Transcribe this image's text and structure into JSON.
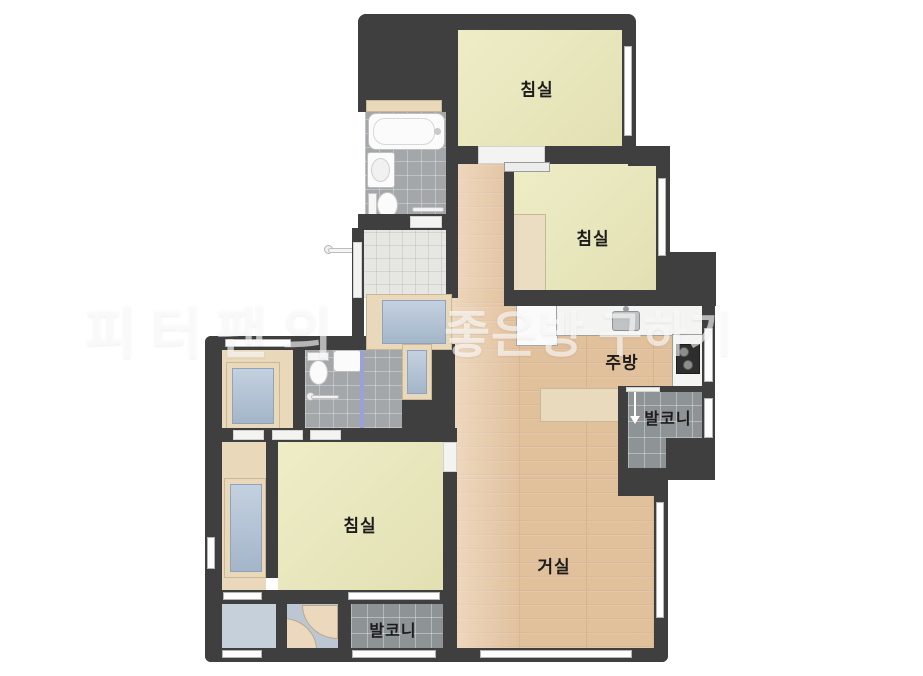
{
  "floorplan": {
    "rooms": {
      "bedroom_top": {
        "label": "침실"
      },
      "bedroom_right": {
        "label": "침실"
      },
      "bedroom_left": {
        "label": "침실"
      },
      "kitchen": {
        "label": "주방"
      },
      "living_room": {
        "label": "거실"
      },
      "balcony_right": {
        "label": "발코니"
      },
      "balcony_bottom": {
        "label": "발코니"
      }
    },
    "watermark": {
      "part1": "피터팬의",
      "part2": "좋은방",
      "part3": "구하기"
    },
    "colors": {
      "wall": "#3f3f3f",
      "bedroom_floor": "#ebe9ba",
      "wood_floor": "#e1c09c",
      "bathroom_tile": "#a4a7a9",
      "balcony_tile": "#8e9396",
      "entry_tile": "#e6e6e3",
      "utility_floor": "#c6d0da",
      "furniture_beige": "#e9d8ba",
      "furniture_blue": "#afc1d6",
      "counter_white": "#f4f4f3",
      "shower_partition": "#9ba0d8",
      "watermark_white": "rgba(255,255,255,0.62)"
    }
  }
}
